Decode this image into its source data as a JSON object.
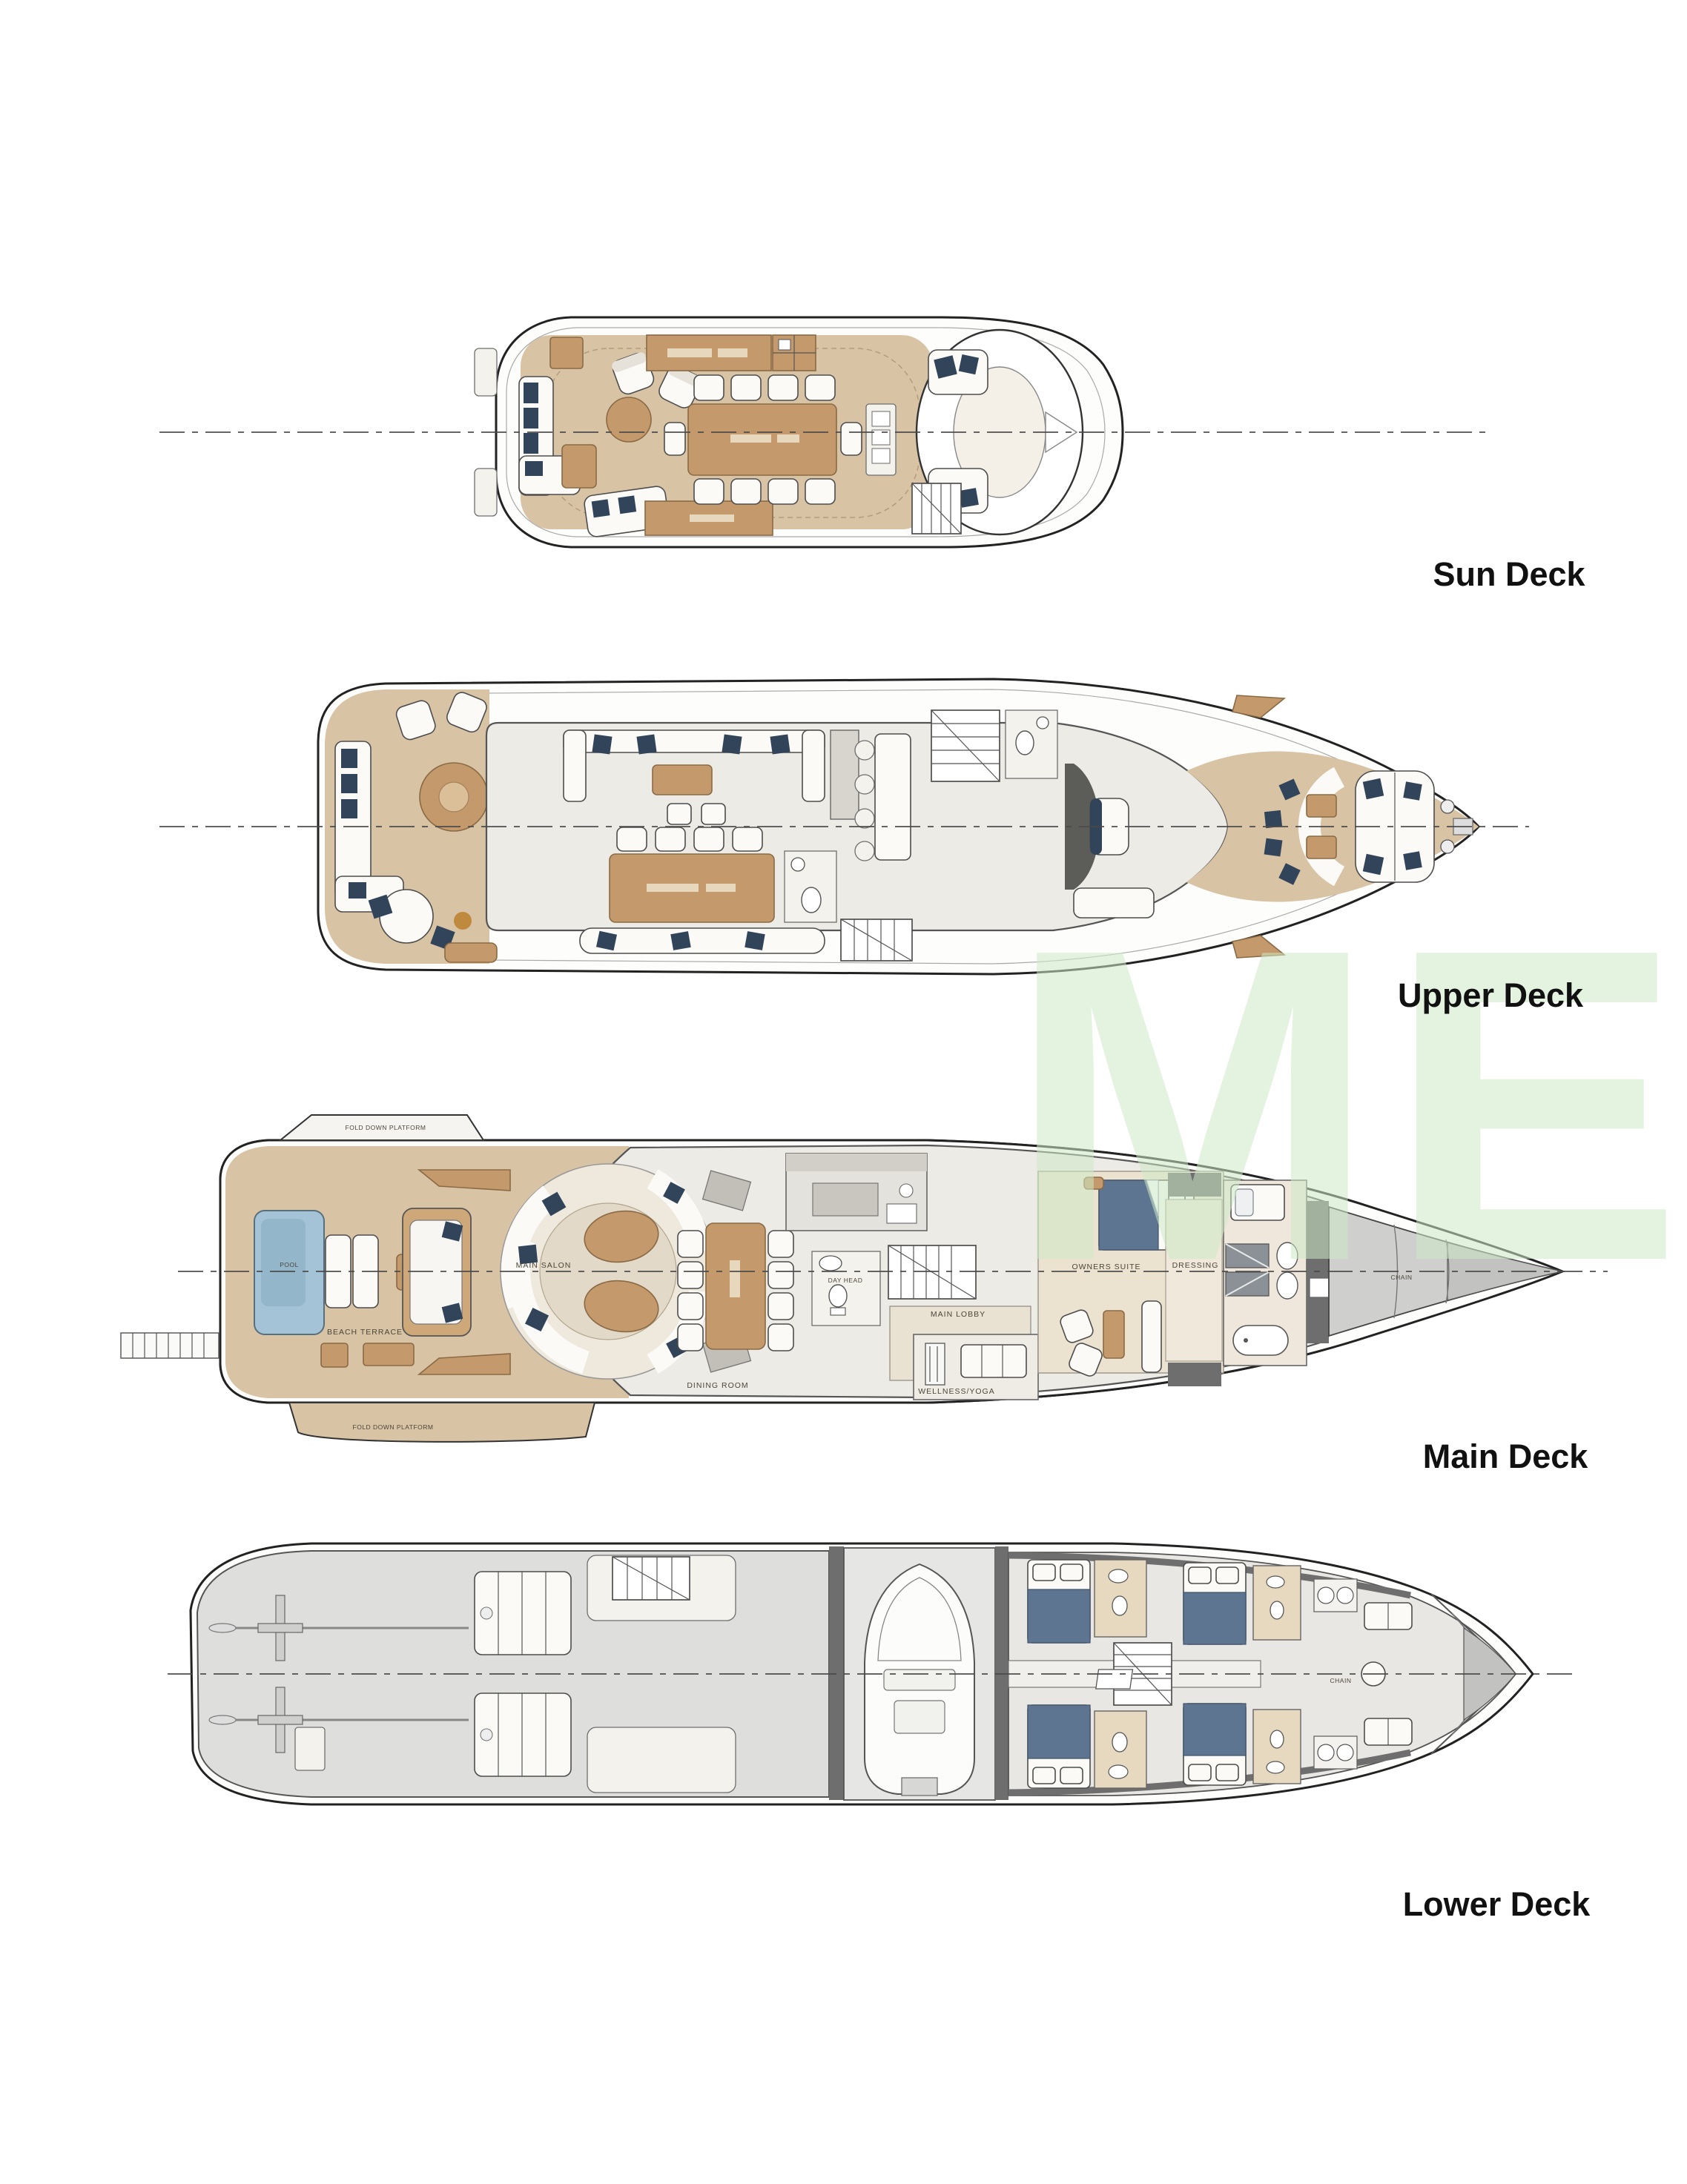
{
  "page": {
    "background": "#ffffff",
    "watermark": {
      "text": "ME",
      "color": "#cdeac6"
    }
  },
  "decks": [
    {
      "name": "sun-deck",
      "label": "Sun Deck",
      "annotations": []
    },
    {
      "name": "upper-deck",
      "label": "Upper Deck",
      "annotations": []
    },
    {
      "name": "main-deck",
      "label": "Main Deck",
      "annotations": [
        {
          "text": "POOL"
        },
        {
          "text": "BEACH TERRACE"
        },
        {
          "text": "MAIN SALON"
        },
        {
          "text": "DINING ROOM"
        },
        {
          "text": "DAY HEAD"
        },
        {
          "text": "MAIN LOBBY"
        },
        {
          "text": "OWNERS SUITE"
        },
        {
          "text": "DRESSING"
        },
        {
          "text": "WELLNESS/YOGA"
        },
        {
          "text": "CHAIN"
        },
        {
          "text": "FOLD DOWN PLATFORM"
        },
        {
          "text": "FOLD DOWN PLATFORM"
        }
      ]
    },
    {
      "name": "lower-deck",
      "label": "Lower Deck",
      "annotations": [
        {
          "text": "CHAIN"
        }
      ]
    }
  ],
  "colors": {
    "page_bg": "#ffffff",
    "hull_outline": "#222222",
    "deck_wood": "#d8c3a5",
    "deck_wood_light": "#e2d1b6",
    "furniture_wood": "#c49a6c",
    "interior_floor": "#edebe6",
    "cushion_navy": "#31445a",
    "pool_water": "#a5c3d6",
    "pool_water_dark": "#8db1c6",
    "wall_gray": "#6e6e6e",
    "centerline_color": "#4a4a4a",
    "label_color": "#4c463a",
    "title_color": "#111111",
    "watermark_green": "#cdeac6"
  }
}
